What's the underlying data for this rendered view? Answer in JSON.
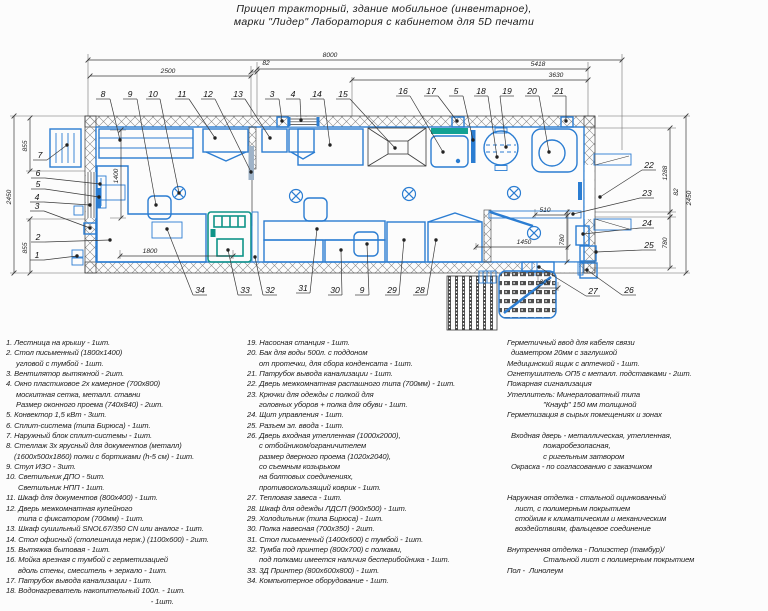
{
  "title": {
    "line1": "Прицеп тракторный, здание мобильное (инвентарное),",
    "line2": "марки \"Лидер\" Лаборатория с кабинетом для 5D печати"
  },
  "plan": {
    "dimensions": [
      {
        "t": "8000",
        "x1": 88,
        "y1": 60,
        "x2": 622,
        "y2": 60,
        "tx": 330,
        "ty": 57
      },
      {
        "t": "2500",
        "x1": 90,
        "y1": 76,
        "x2": 251,
        "y2": 76,
        "tx": 168,
        "ty": 73
      },
      {
        "t": "82",
        "x1": 251,
        "y1": 72,
        "x2": 257,
        "y2": 72,
        "tx": 266,
        "ty": 65
      },
      {
        "t": "5418",
        "x1": 257,
        "y1": 69,
        "x2": 588,
        "y2": 69,
        "tx": 538,
        "ty": 66
      },
      {
        "t": "3630",
        "x1": 352,
        "y1": 80,
        "x2": 588,
        "y2": 80,
        "tx": 556,
        "ty": 77
      },
      {
        "t": "855",
        "x1": 30,
        "y1": 118,
        "x2": 30,
        "y2": 171,
        "tx": 27,
        "ty": 146,
        "r": 1
      },
      {
        "t": "2450",
        "x1": 14,
        "y1": 116,
        "x2": 14,
        "y2": 273,
        "tx": 11,
        "ty": 197,
        "r": 1
      },
      {
        "t": "855",
        "x1": 30,
        "y1": 219,
        "x2": 30,
        "y2": 273,
        "tx": 27,
        "ty": 248,
        "r": 1
      },
      {
        "t": "1400",
        "x1": 121,
        "y1": 130,
        "x2": 121,
        "y2": 218,
        "tx": 118,
        "ty": 176,
        "r": 1
      },
      {
        "t": "1800",
        "x1": 120,
        "y1": 256,
        "x2": 233,
        "y2": 256,
        "tx": 150,
        "ty": 253
      },
      {
        "t": "510",
        "x1": 535,
        "y1": 215,
        "x2": 568,
        "y2": 215,
        "tx": 545,
        "ty": 212
      },
      {
        "t": "1450",
        "x1": 476,
        "y1": 247,
        "x2": 568,
        "y2": 247,
        "tx": 524,
        "ty": 244
      },
      {
        "t": "780",
        "x1": 567,
        "y1": 212,
        "x2": 567,
        "y2": 262,
        "tx": 564,
        "ty": 240,
        "r": 1
      },
      {
        "t": "1288",
        "x1": 670,
        "y1": 128,
        "x2": 670,
        "y2": 212,
        "tx": 667,
        "ty": 173,
        "r": 1
      },
      {
        "t": "82",
        "x1": 670,
        "y1": 212,
        "x2": 670,
        "y2": 217,
        "tx": 678,
        "ty": 192,
        "r": 1
      },
      {
        "t": "780",
        "x1": 670,
        "y1": 217,
        "x2": 670,
        "y2": 268,
        "tx": 667,
        "ty": 243,
        "r": 1
      },
      {
        "t": "2450",
        "x1": 686,
        "y1": 116,
        "x2": 686,
        "y2": 273,
        "tx": 691,
        "ty": 198,
        "r": 1
      },
      {
        "t": "300",
        "x1": 538,
        "y1": 288,
        "x2": 558,
        "y2": 288,
        "tx": 545,
        "ty": 284
      }
    ],
    "callouts": [
      {
        "n": "8",
        "x": 103,
        "y": 97,
        "tx": 120,
        "ty": 140
      },
      {
        "n": "9",
        "x": 130,
        "y": 97,
        "tx": 156,
        "ty": 205
      },
      {
        "n": "10",
        "x": 153,
        "y": 97,
        "tx": 179,
        "ty": 193
      },
      {
        "n": "11",
        "x": 182,
        "y": 97,
        "tx": 215,
        "ty": 138
      },
      {
        "n": "12",
        "x": 208,
        "y": 97,
        "tx": 251,
        "ty": 172
      },
      {
        "n": "13",
        "x": 238,
        "y": 97,
        "tx": 270,
        "ty": 138
      },
      {
        "n": "3",
        "x": 272,
        "y": 97,
        "tx": 282,
        "ty": 121
      },
      {
        "n": "4",
        "x": 293,
        "y": 97,
        "tx": 301,
        "ty": 120
      },
      {
        "n": "14",
        "x": 317,
        "y": 97,
        "tx": 330,
        "ty": 145
      },
      {
        "n": "15",
        "x": 343,
        "y": 97,
        "tx": 395,
        "ty": 148
      },
      {
        "n": "16",
        "x": 403,
        "y": 94,
        "tx": 443,
        "ty": 152
      },
      {
        "n": "17",
        "x": 431,
        "y": 94,
        "tx": 457,
        "ty": 121
      },
      {
        "n": "5",
        "x": 456,
        "y": 94,
        "tx": 473,
        "ty": 140
      },
      {
        "n": "18",
        "x": 481,
        "y": 94,
        "tx": 497,
        "ty": 157
      },
      {
        "n": "19",
        "x": 507,
        "y": 94,
        "tx": 506,
        "ty": 147
      },
      {
        "n": "20",
        "x": 532,
        "y": 94,
        "tx": 549,
        "ty": 152
      },
      {
        "n": "21",
        "x": 559,
        "y": 94,
        "tx": 566,
        "ty": 121
      },
      {
        "n": "7",
        "x": 40,
        "y": 158,
        "tx": 67,
        "ty": 145
      },
      {
        "n": "6",
        "x": 38,
        "y": 176,
        "tx": 100,
        "ty": 184
      },
      {
        "n": "5",
        "x": 38,
        "y": 187,
        "tx": 99,
        "ty": 197
      },
      {
        "n": "4",
        "x": 37,
        "y": 200,
        "tx": 90,
        "ty": 205
      },
      {
        "n": "3",
        "x": 37,
        "y": 209,
        "tx": 90,
        "ty": 228
      },
      {
        "n": "2",
        "x": 38,
        "y": 240,
        "tx": 110,
        "ty": 240
      },
      {
        "n": "1",
        "x": 37,
        "y": 258,
        "tx": 77,
        "ty": 256
      },
      {
        "n": "22",
        "x": 649,
        "y": 168,
        "tx": 600,
        "ty": 197
      },
      {
        "n": "23",
        "x": 647,
        "y": 196,
        "tx": 573,
        "ty": 214
      },
      {
        "n": "24",
        "x": 647,
        "y": 226,
        "tx": 583,
        "ty": 234
      },
      {
        "n": "25",
        "x": 649,
        "y": 248,
        "tx": 596,
        "ty": 252
      },
      {
        "n": "26",
        "x": 629,
        "y": 293,
        "tx": 587,
        "ty": 270
      },
      {
        "n": "27",
        "x": 593,
        "y": 294,
        "tx": 539,
        "ty": 267
      },
      {
        "n": "34",
        "x": 200,
        "y": 293,
        "tx": 167,
        "ty": 229
      },
      {
        "n": "33",
        "x": 245,
        "y": 293,
        "tx": 228,
        "ty": 250
      },
      {
        "n": "32",
        "x": 270,
        "y": 293,
        "tx": 255,
        "ty": 257
      },
      {
        "n": "31",
        "x": 303,
        "y": 291,
        "tx": 317,
        "ty": 229
      },
      {
        "n": "30",
        "x": 335,
        "y": 293,
        "tx": 341,
        "ty": 250
      },
      {
        "n": "9",
        "x": 362,
        "y": 293,
        "tx": 367,
        "ty": 244
      },
      {
        "n": "29",
        "x": 392,
        "y": 293,
        "tx": 404,
        "ty": 240
      },
      {
        "n": "28",
        "x": 420,
        "y": 293,
        "tx": 436,
        "ty": 240
      }
    ]
  },
  "legend": {
    "left": [
      "1. Лестница на крышу - 1шт.",
      "2. Стол письменный (1800х1400)",
      "     угловой с тумбой - 1шт.",
      "3. Вентилятор вытяжной - 2шт.",
      "4. Окно пластиковое 2х камерное (700х800)",
      "     москитная сетка, металл. ставни",
      "     Размер оконного проема (740х840) - 2шт.",
      "5. Конвектор 1,5 кВт - 3шт.",
      "6. Сплит-система (типа Бирюса) - 1шт.",
      "7. Наружный блок сплит-системы - 1шт.",
      "8. Стеллаж 3х ярусный для документов (металл)",
      "    (1600х500х1860) полки с бортиками (h-5 см) - 1шт.",
      "9. Стул ИЗО - 3шт.",
      "10. Светильник ДПО - 5шт.",
      "      Светильник НПП - 1шт.",
      "11. Шкаф для документов (800х400) - 1шт.",
      "12. Дверь межкомнатная купейного",
      "      типа с фиксатором (700мм) - 1шт.",
      "13. Шкаф сушильный SNOL67/350 CN или аналог - 1шт.",
      "14. Стол офисный (столешница нерж.) (1100х600) - 2шт.",
      "15. Вытяжка бытовая - 1шт.",
      "16. Мойка врезная с тумбой с герметизацией",
      "      вдоль стены, смеситель + зеркало - 1шт.",
      "17. Патрубок вывода канализации - 1шт.",
      "18. Водонагреватель накопительный 100л. - 1шт.",
      "                                                                        - 1шт."
    ],
    "mid": [
      "19. Насосная станция - 1шт.",
      "20. Бак для воды 500л. с поддоном",
      "      от протечки, для сбора конденсата - 1шт.",
      "21. Патрубок вывода канализации - 1шт.",
      "22. Дверь межкомнатная распашного типа (700мм) - 1шт.",
      "23. Крючки для одежды с полкой для",
      "      головных уборов + полка для обуви - 1шт.",
      "24. Щит управления - 1шт.",
      "25. Разъем эл. ввода - 1шт.",
      "26. Дверь входная утепленная (1000х2000),",
      "      с отбойником/ограничителем",
      "      размер дверного проема (1020х2040),",
      "      со съемным козырьком",
      "      на болтовых соединениях,",
      "      противоскользящий коврик - 1шт.",
      "27. Тепловая завеса - 1шт.",
      "28. Шкаф для одежды ЛДСП (900х500) - 1шт.",
      "29. Холодильник (типа Бирюса) - 1шт.",
      "30. Полка навесная (700х350) - 2шт.",
      "31. Стол письменный (1400х600) с тумбой - 1шт.",
      "32. Тумба под принтер (800х700) с полками,",
      "      под полками имеется наличия бесперибойника - 1шт.",
      "33. 3Д Принтер (800х600х800) - 1шт.",
      "34. Компьютерное оборудование - 1шт."
    ],
    "right": [
      "Герметичный ввод для кабеля связи",
      "  диаметром 20мм с заглушкой",
      "Медицинский ящик с аптечкой - 1шт.",
      "Огнетушитель ОП5 с металл. подставками - 2шт.",
      "Пожарная сигнализация",
      "Утеплитель: Минераловатный типа",
      "                  \"Кнауф\" 150 мм толщиной",
      "Герметизация в сырых помещениях и зонах",
      "",
      "  Входная дверь - металлическая, утепленная,",
      "                  пожаробезопасная,",
      "                  с ригельным затвором",
      "  Окраска - по согласованию с заказчиком",
      "",
      "",
      "Наружная отделка - стальной оцинкованный",
      "    лист, с полимерным покрытием",
      "    стойким к климатическим и механическим",
      "    воздействиям, фальцевое соединение",
      "",
      "Внутренняя отделка - Полиэстер (тамбур)/",
      "                  Стальной лист с полимерным покрытием",
      "Пол -  Линолеум"
    ]
  }
}
